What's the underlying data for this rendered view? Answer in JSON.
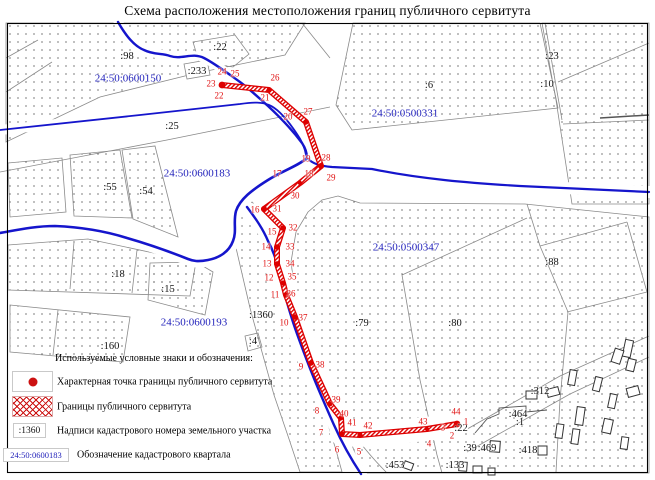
{
  "title": "Схема расположения местоположения границ публичного сервитута",
  "colors": {
    "servitude_red": "#e00000",
    "line_blue": "#1515cc",
    "quarter_label_blue": "#2323bb",
    "parcel_outline_gray": "#8a8a8a"
  },
  "legend": {
    "title": "Используемые условные знаки и обозначения:",
    "items": [
      {
        "symbol": "red-point",
        "label": "Характерная точка границы публичного сервитута"
      },
      {
        "symbol": "red-crosshatch",
        "label": "Границы публичного сервитута"
      },
      {
        "symbol": "parcel-number-sample",
        "symbol_text": ":1360",
        "label": "Надписи кадастрового номера земельного участка"
      },
      {
        "symbol": "quarter-number-sample",
        "symbol_text": "24:50:0600183",
        "label": "Обозначение кадастрового квартала"
      }
    ]
  },
  "quarters": [
    {
      "label": "24:50:0600150",
      "x": 128,
      "y": 79
    },
    {
      "label": "24:50:0500331",
      "x": 405,
      "y": 114
    },
    {
      "label": "24:50:0600183",
      "x": 197,
      "y": 174
    },
    {
      "label": "24:50:0500347",
      "x": 406,
      "y": 248
    },
    {
      "label": "24:50:0600193",
      "x": 194,
      "y": 323
    }
  ],
  "parcels": [
    {
      "label": ":98",
      "x": 127,
      "y": 57
    },
    {
      "label": ":22",
      "x": 220,
      "y": 48
    },
    {
      "label": ":233",
      "x": 197,
      "y": 72
    },
    {
      "label": ":25",
      "x": 172,
      "y": 127
    },
    {
      "label": ":6",
      "x": 429,
      "y": 86
    },
    {
      "label": ":23",
      "x": 552,
      "y": 57
    },
    {
      "label": ":10",
      "x": 547,
      "y": 85
    },
    {
      "label": ":55",
      "x": 110,
      "y": 188
    },
    {
      "label": ":54",
      "x": 146,
      "y": 192
    },
    {
      "label": ":18",
      "x": 118,
      "y": 275
    },
    {
      "label": ":15",
      "x": 168,
      "y": 290
    },
    {
      "label": ":160",
      "x": 110,
      "y": 347
    },
    {
      "label": ":1360",
      "x": 261,
      "y": 316
    },
    {
      "label": ":4",
      "x": 253,
      "y": 342
    },
    {
      "label": ":79",
      "x": 362,
      "y": 324
    },
    {
      "label": ":80",
      "x": 455,
      "y": 324
    },
    {
      "label": ":88",
      "x": 552,
      "y": 263
    },
    {
      "label": ":312",
      "x": 540,
      "y": 392
    },
    {
      "label": ":464",
      "x": 518,
      "y": 415
    },
    {
      "label": ":1",
      "x": 520,
      "y": 423
    },
    {
      "label": ":22",
      "x": 461,
      "y": 429
    },
    {
      "label": ":39",
      "x": 470,
      "y": 449
    },
    {
      "label": ":469",
      "x": 487,
      "y": 449
    },
    {
      "label": ":418",
      "x": 528,
      "y": 451
    },
    {
      "label": ":133",
      "x": 455,
      "y": 466
    },
    {
      "label": ":453",
      "x": 395,
      "y": 466
    }
  ],
  "points": [
    {
      "label": "1",
      "x": 466,
      "y": 422
    },
    {
      "label": "2",
      "x": 452,
      "y": 436
    },
    {
      "label": "3",
      "x": 443,
      "y": 428
    },
    {
      "label": "4",
      "x": 429,
      "y": 444
    },
    {
      "label": "5",
      "x": 359,
      "y": 452
    },
    {
      "label": "6",
      "x": 337,
      "y": 450
    },
    {
      "label": "7",
      "x": 321,
      "y": 433
    },
    {
      "label": "8",
      "x": 317,
      "y": 411
    },
    {
      "label": "9",
      "x": 301,
      "y": 367
    },
    {
      "label": "10",
      "x": 284,
      "y": 323
    },
    {
      "label": "11",
      "x": 275,
      "y": 295
    },
    {
      "label": "12",
      "x": 269,
      "y": 278
    },
    {
      "label": "13",
      "x": 267,
      "y": 264
    },
    {
      "label": "14",
      "x": 266,
      "y": 247
    },
    {
      "label": "15",
      "x": 272,
      "y": 232
    },
    {
      "label": "16",
      "x": 255,
      "y": 210
    },
    {
      "label": "17",
      "x": 277,
      "y": 174
    },
    {
      "label": "18",
      "x": 309,
      "y": 174
    },
    {
      "label": "19",
      "x": 306,
      "y": 159
    },
    {
      "label": "20",
      "x": 288,
      "y": 117
    },
    {
      "label": "21",
      "x": 265,
      "y": 98
    },
    {
      "label": "22",
      "x": 219,
      "y": 96
    },
    {
      "label": "23",
      "x": 211,
      "y": 84
    },
    {
      "label": "24",
      "x": 222,
      "y": 72
    },
    {
      "label": "25",
      "x": 235,
      "y": 74
    },
    {
      "label": "26",
      "x": 275,
      "y": 78
    },
    {
      "label": "27",
      "x": 308,
      "y": 112
    },
    {
      "label": "28",
      "x": 326,
      "y": 158
    },
    {
      "label": "29",
      "x": 331,
      "y": 178
    },
    {
      "label": "30",
      "x": 295,
      "y": 196
    },
    {
      "label": "31",
      "x": 277,
      "y": 209
    },
    {
      "label": "32",
      "x": 293,
      "y": 228
    },
    {
      "label": "33",
      "x": 290,
      "y": 247
    },
    {
      "label": "34",
      "x": 290,
      "y": 264
    },
    {
      "label": "35",
      "x": 292,
      "y": 277
    },
    {
      "label": "36",
      "x": 291,
      "y": 294
    },
    {
      "label": "37",
      "x": 303,
      "y": 318
    },
    {
      "label": "38",
      "x": 320,
      "y": 365
    },
    {
      "label": "39",
      "x": 336,
      "y": 400
    },
    {
      "label": "40",
      "x": 344,
      "y": 414
    },
    {
      "label": "41",
      "x": 352,
      "y": 423
    },
    {
      "label": "42",
      "x": 368,
      "y": 426
    },
    {
      "label": "43",
      "x": 423,
      "y": 422
    },
    {
      "label": "44",
      "x": 456,
      "y": 412
    }
  ]
}
